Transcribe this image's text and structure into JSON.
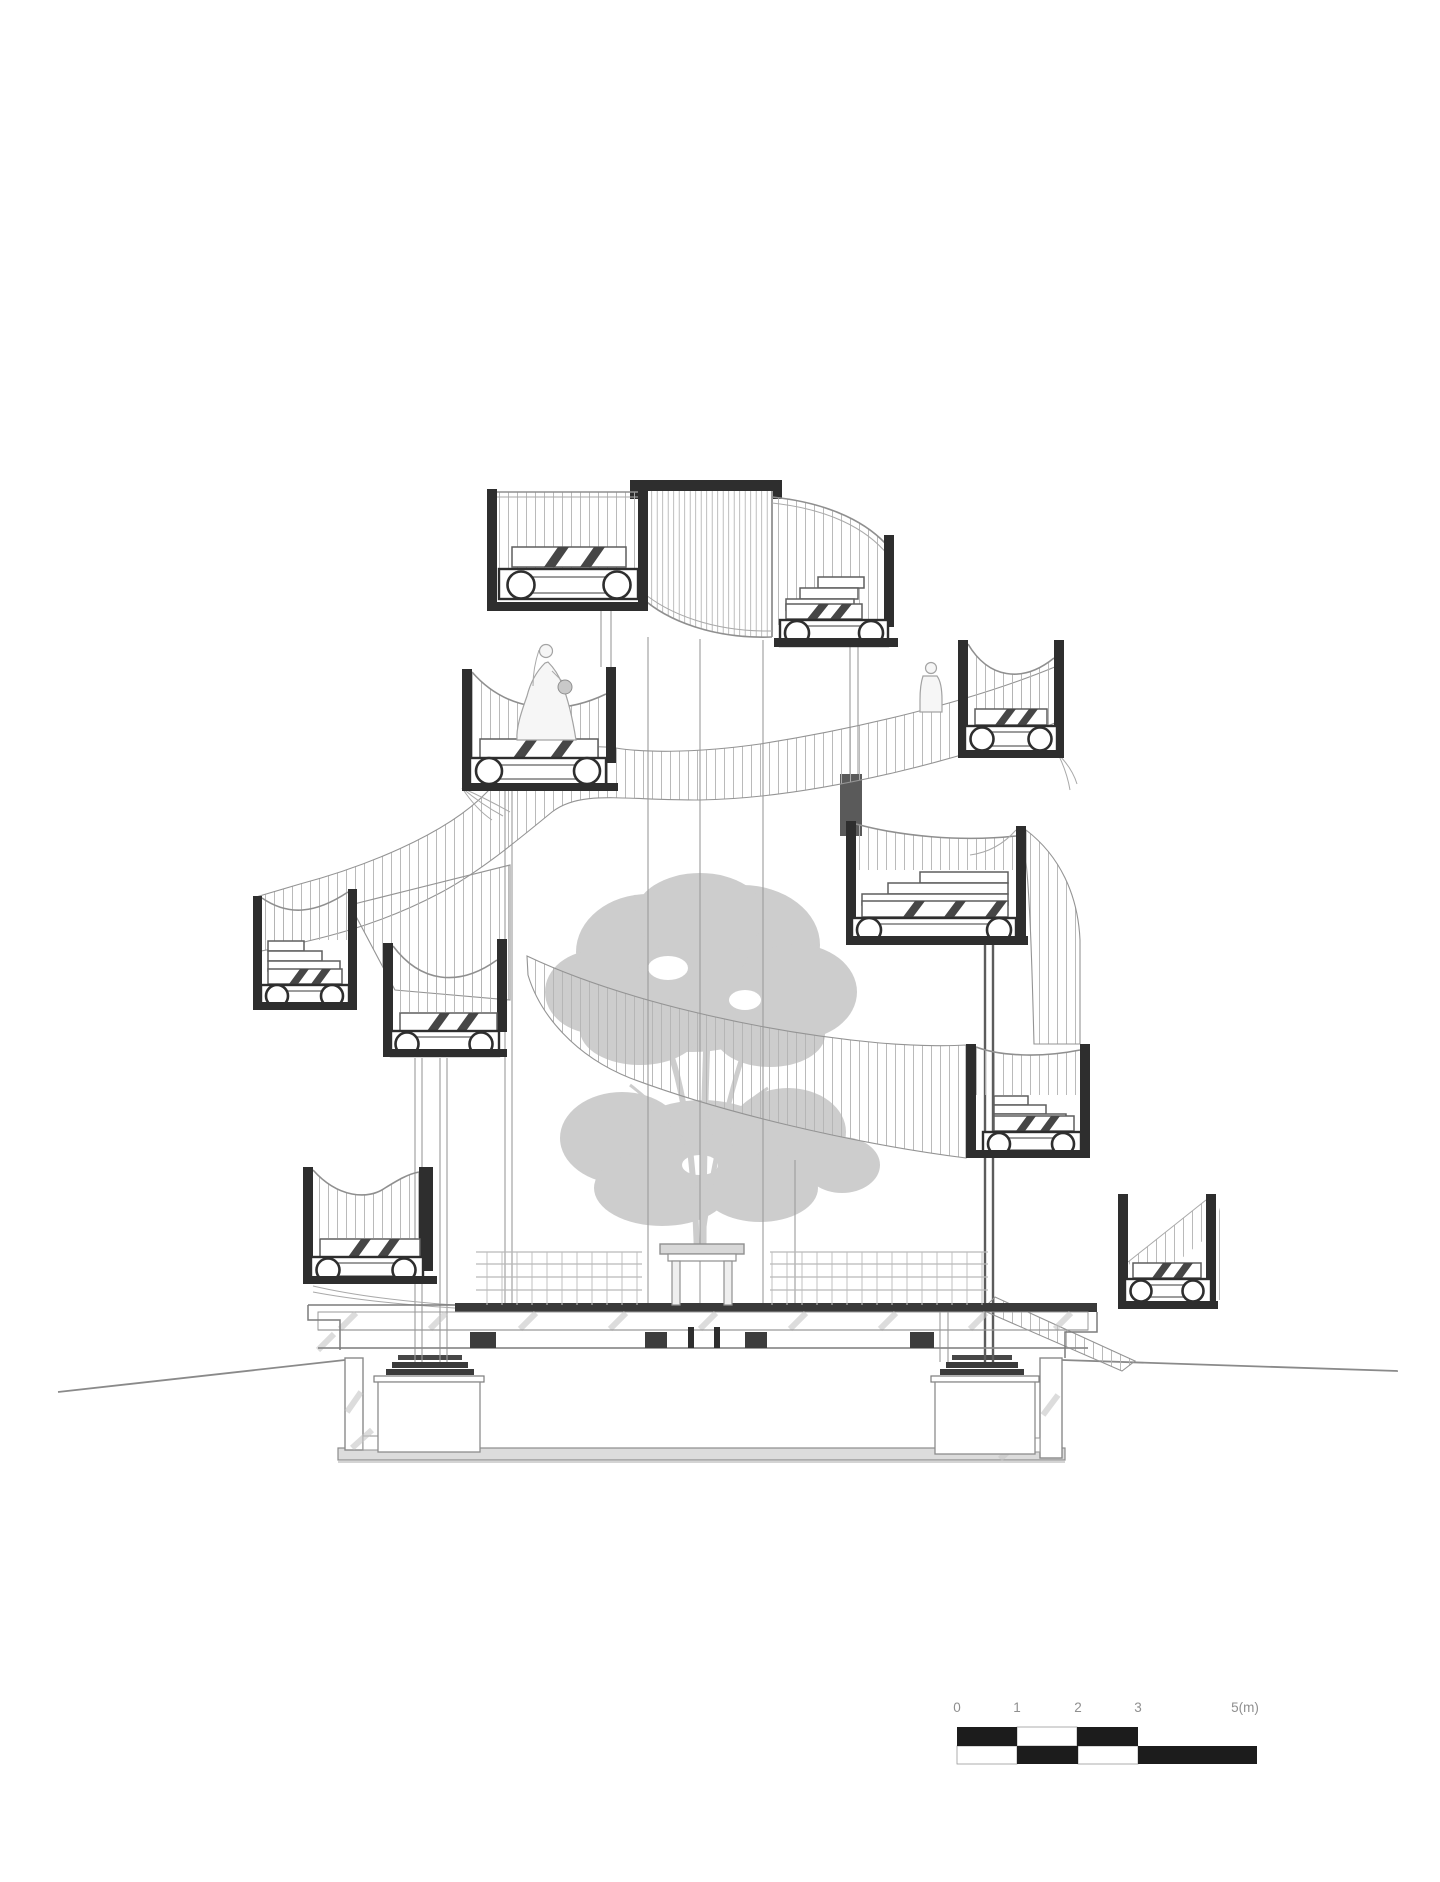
{
  "document": {
    "kind": "architectural section drawing",
    "subject": "spiral-ramp pavilion with cantilevered room pods around a central tree"
  },
  "scale_bar": {
    "unit": "m",
    "labels": [
      "0",
      "1",
      "2",
      "3",
      "5(m)"
    ]
  },
  "figures": [
    {
      "name": "bride figure on upper pod"
    },
    {
      "name": "standing figure on ramp"
    }
  ],
  "colors": {
    "background": "#ffffff",
    "ink": "#2e2e2e",
    "line": "#7c7c7c",
    "light": "#a9a9a9",
    "hatch": "#b3b3b3",
    "tree": "#cbcbcb",
    "black": "#1c1c1c",
    "scale_text": "#8f8f8f"
  }
}
